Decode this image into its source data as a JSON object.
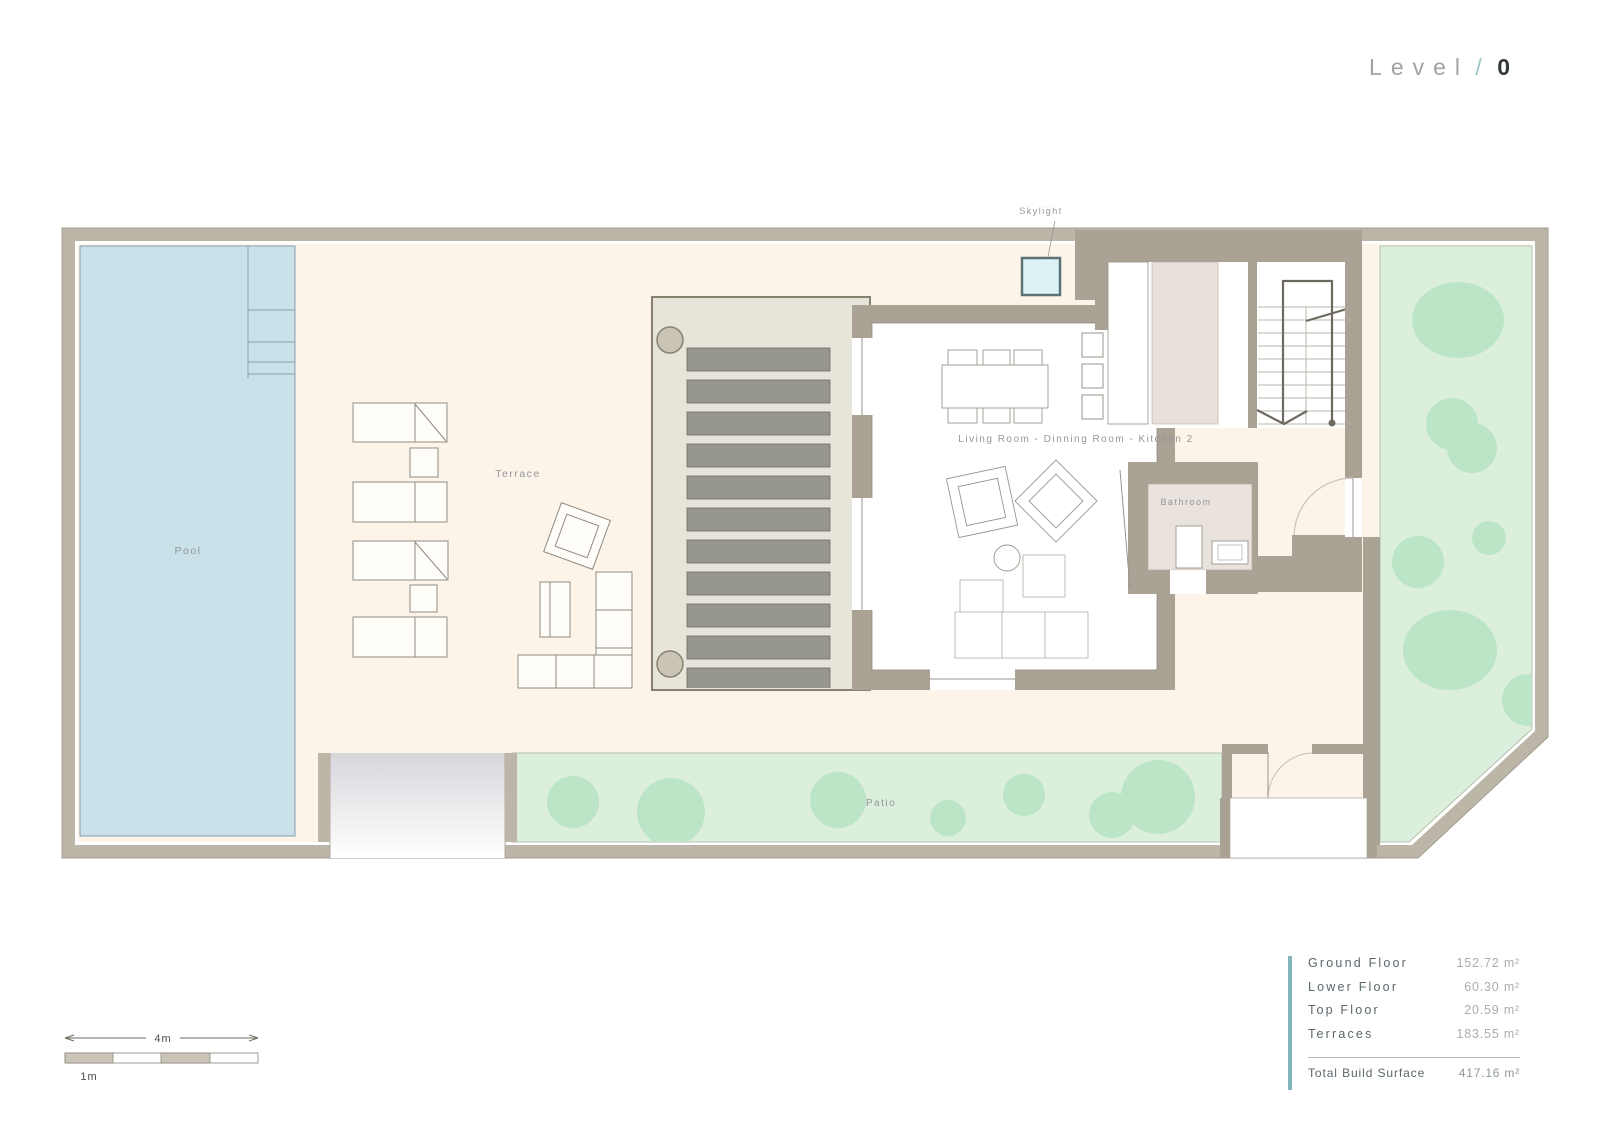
{
  "title": {
    "level_label": "Level",
    "separator": "/",
    "level_number": "0"
  },
  "plan": {
    "labels": {
      "pool": "Pool",
      "terrace": "Terrace",
      "skylight": "Skylight",
      "living": "Living Room - Dinning Room - Kitchen 2",
      "bathroom": "Bathroom",
      "patio": "Patio"
    }
  },
  "scale_bar": {
    "total_label": "4m",
    "unit_label": "1m"
  },
  "area_table": {
    "rows": [
      {
        "label": "Ground Floor",
        "value": "152.72 m²"
      },
      {
        "label": "Lower Floor",
        "value": "60.30 m²"
      },
      {
        "label": "Top Floor",
        "value": "20.59 m²"
      },
      {
        "label": "Terraces",
        "value": "183.55 m²"
      }
    ],
    "total": {
      "label": "Total Build Surface",
      "value": "417.16 m²"
    }
  },
  "colors": {
    "accent_teal": "#82b5bb",
    "boundary_wall": "#bcb6a9",
    "building_wall": "#a9a295",
    "terrace_cream": "#fcf4e9",
    "pool_blue": "#c9e2ea",
    "skylight_cyan": "#dcf3f6",
    "garden_green": "#dcefdd",
    "tree_green": "#bce4c6",
    "kitchen_pink": "#e9e0dc",
    "pergola_slat": "#98978f"
  }
}
